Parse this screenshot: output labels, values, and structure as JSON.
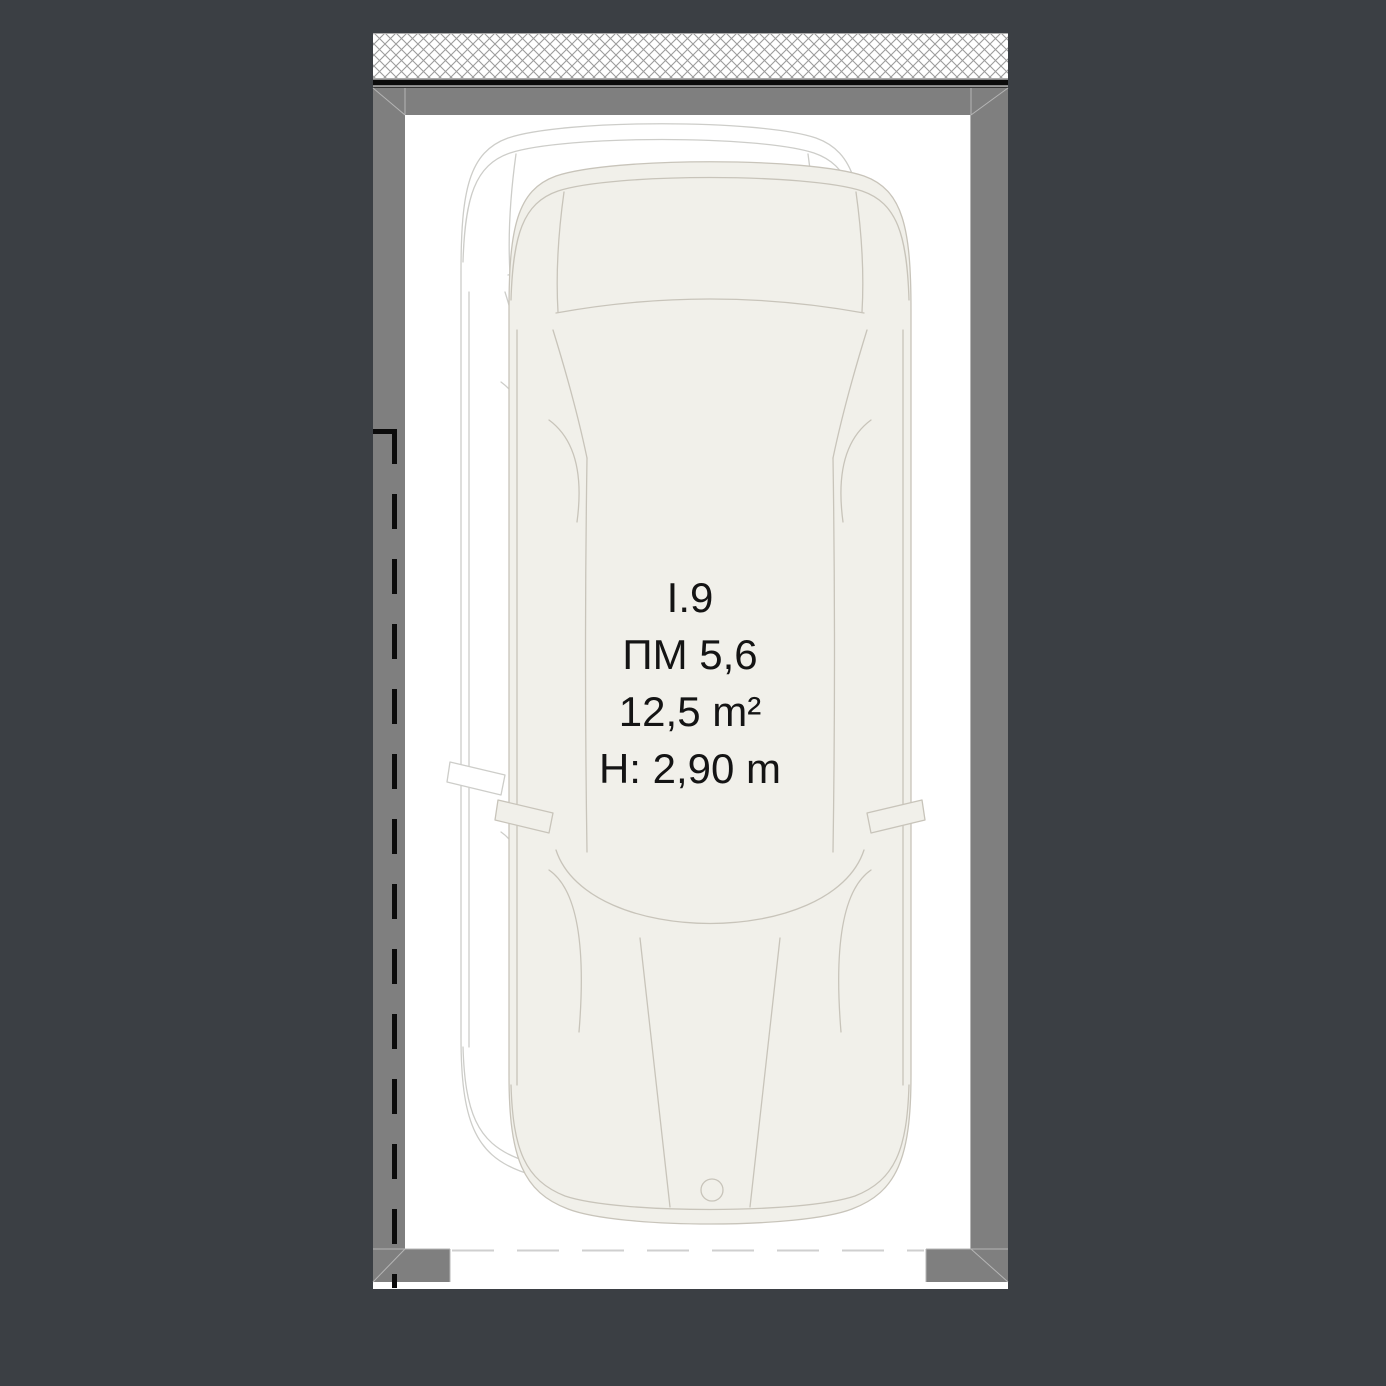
{
  "plan": {
    "type_label": "parking space floor plan",
    "labels": {
      "unit": "I.9",
      "parking_number": "ПМ 5,6",
      "area": "12,5 m²",
      "clear_height": "H: 2,90 m"
    }
  },
  "colors": {
    "background": "#3B3F44",
    "plan_background": "#FFFFFF",
    "wall": "#7F7F7F",
    "wall_joint_line": "#B5B5B5",
    "hatch_line": "#9C9C9C",
    "hatch_border": "#ABABAB",
    "structure_black_line": "#0B0B0B",
    "boundary_dash": "#0B0B0B",
    "floor_dash": "#CFCFCF",
    "car_fill": "#F1F0EA",
    "car_stroke": "#C8C4BA",
    "ghost_car_fill": "#FFFFFF",
    "ghost_car_stroke": "#CDCDC9",
    "text": "#141414"
  }
}
